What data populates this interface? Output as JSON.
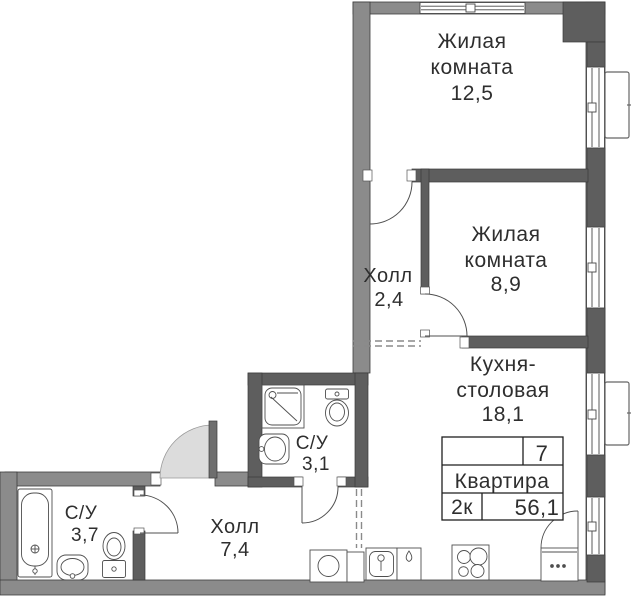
{
  "plan": {
    "labels": {
      "room1": {
        "l1": "Жилая",
        "l2": "комната",
        "area": "12,5"
      },
      "room2": {
        "l1": "Жилая",
        "l2": "комната",
        "area": "8,9"
      },
      "hall_upper": {
        "l1": "Холл",
        "area": "2,4"
      },
      "kitchen": {
        "l1": "Кухня-",
        "l2": "столовая",
        "area": "18,1"
      },
      "bath_small": {
        "l1": "С/У",
        "area": "3,1"
      },
      "bath_big": {
        "l1": "С/У",
        "area": "3,7"
      },
      "hall_lower": {
        "l1": "Холл",
        "area": "7,4"
      }
    },
    "info_table": {
      "floor": "7",
      "title": "Квартира",
      "rooms_type": "2к",
      "total_area": "56,1",
      "empty_cell": ""
    },
    "colors": {
      "wall_outer": "#8b8b8b",
      "wall_inner": "#5e5e5e",
      "wall_stroke": "#3d3d3d",
      "door_leaf": "#6e6e6e",
      "door_swing_fill": "#dcdcdc",
      "line": "#4f4f4f",
      "dash": "#8a8a8a",
      "text": "#2e2e2e"
    }
  }
}
